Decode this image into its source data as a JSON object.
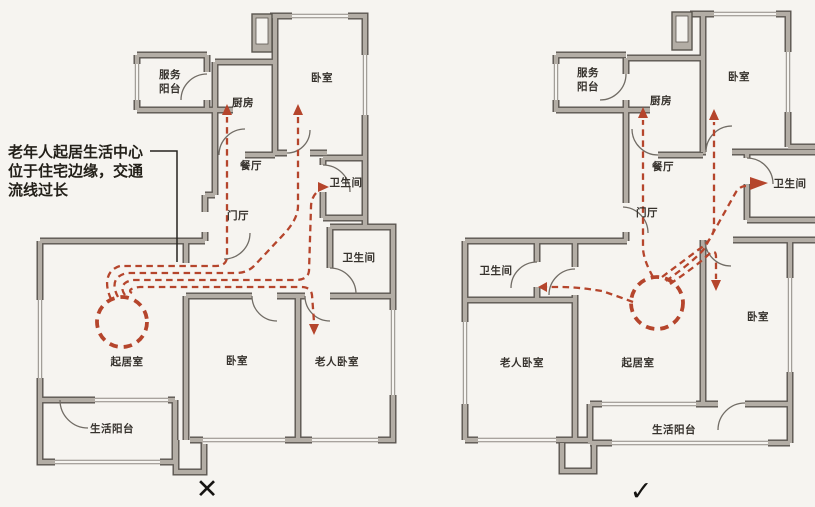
{
  "diagram": {
    "type": "floor-plan-comparison",
    "background": "#f6f4f0"
  },
  "colors": {
    "flow_red": "#b5452c",
    "wall_core": "#b3ada5",
    "wall_edge": "#5a554f",
    "label_text": "#36322d",
    "annotation_text": "#232019",
    "mark_black": "#161412"
  },
  "annotation": {
    "line1": "老年人起居生活中心",
    "line2": "位于住宅边缘，交通",
    "line3": "流线过长"
  },
  "left_plan": {
    "verdict_mark": "✕",
    "rooms": {
      "service_balcony_line1": "服务",
      "service_balcony_line2": "阳台",
      "kitchen": "厨房",
      "bedroom_top": "卧室",
      "dining": "餐厅",
      "bathroom_upper": "卫生间",
      "foyer": "门厅",
      "bathroom_lower": "卫生间",
      "living_room": "起居室",
      "bedroom_middle": "卧室",
      "elder_bedroom": "老人卧室",
      "life_balcony": "生活阳台"
    }
  },
  "right_plan": {
    "verdict_mark": "✓",
    "rooms": {
      "service_balcony_line1": "服务",
      "service_balcony_line2": "阳台",
      "kitchen": "厨房",
      "bedroom_top": "卧室",
      "dining": "餐厅",
      "bathroom_right": "卫生间",
      "foyer": "门厅",
      "bathroom_left": "卫生间",
      "elder_bedroom": "老人卧室",
      "living_room": "起居室",
      "bedroom_right": "卧室",
      "life_balcony": "生活阳台"
    }
  }
}
